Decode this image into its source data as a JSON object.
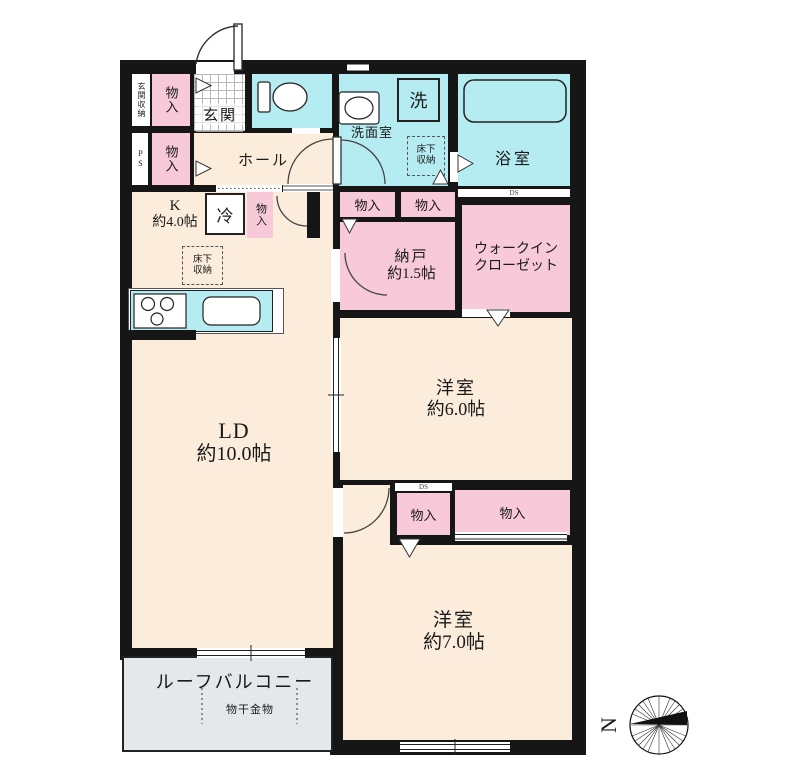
{
  "rooms": {
    "genkan_storage": {
      "label": "玄関収納"
    },
    "storage": {
      "label": "物入"
    },
    "genkan": {
      "label": "玄関"
    },
    "washroom": {
      "label": "洗面室"
    },
    "washer": {
      "label": "洗"
    },
    "bath": {
      "label": "浴室"
    },
    "underfloor": {
      "line1": "床下",
      "line2": "収納"
    },
    "ps": {
      "label": "PS"
    },
    "ds": {
      "label": "DS"
    },
    "hall": {
      "label": "ホール"
    },
    "kitchen": {
      "line1": "K",
      "line2": "約4.0帖"
    },
    "fridge": {
      "label": "冷"
    },
    "ld": {
      "line1": "LD",
      "line2": "約10.0帖"
    },
    "nando": {
      "line1": "納戸",
      "line2": "約1.5帖"
    },
    "wic": {
      "line1": "ウォークイン",
      "line2": "クローゼット"
    },
    "western6": {
      "line1": "洋室",
      "line2": "約6.0帖"
    },
    "western7": {
      "line1": "洋室",
      "line2": "約7.0帖"
    },
    "balcony": {
      "label": "ルーフバルコニー"
    },
    "drying": {
      "label": "物干金物"
    }
  },
  "compass": {
    "north": "N"
  },
  "colors": {
    "wall": "#161616",
    "room_peach": "#fcecdb",
    "storage_pink": "#f8c9d8",
    "water_cyan": "#b5ecf2",
    "balcony_gray": "#e4e8ea"
  }
}
